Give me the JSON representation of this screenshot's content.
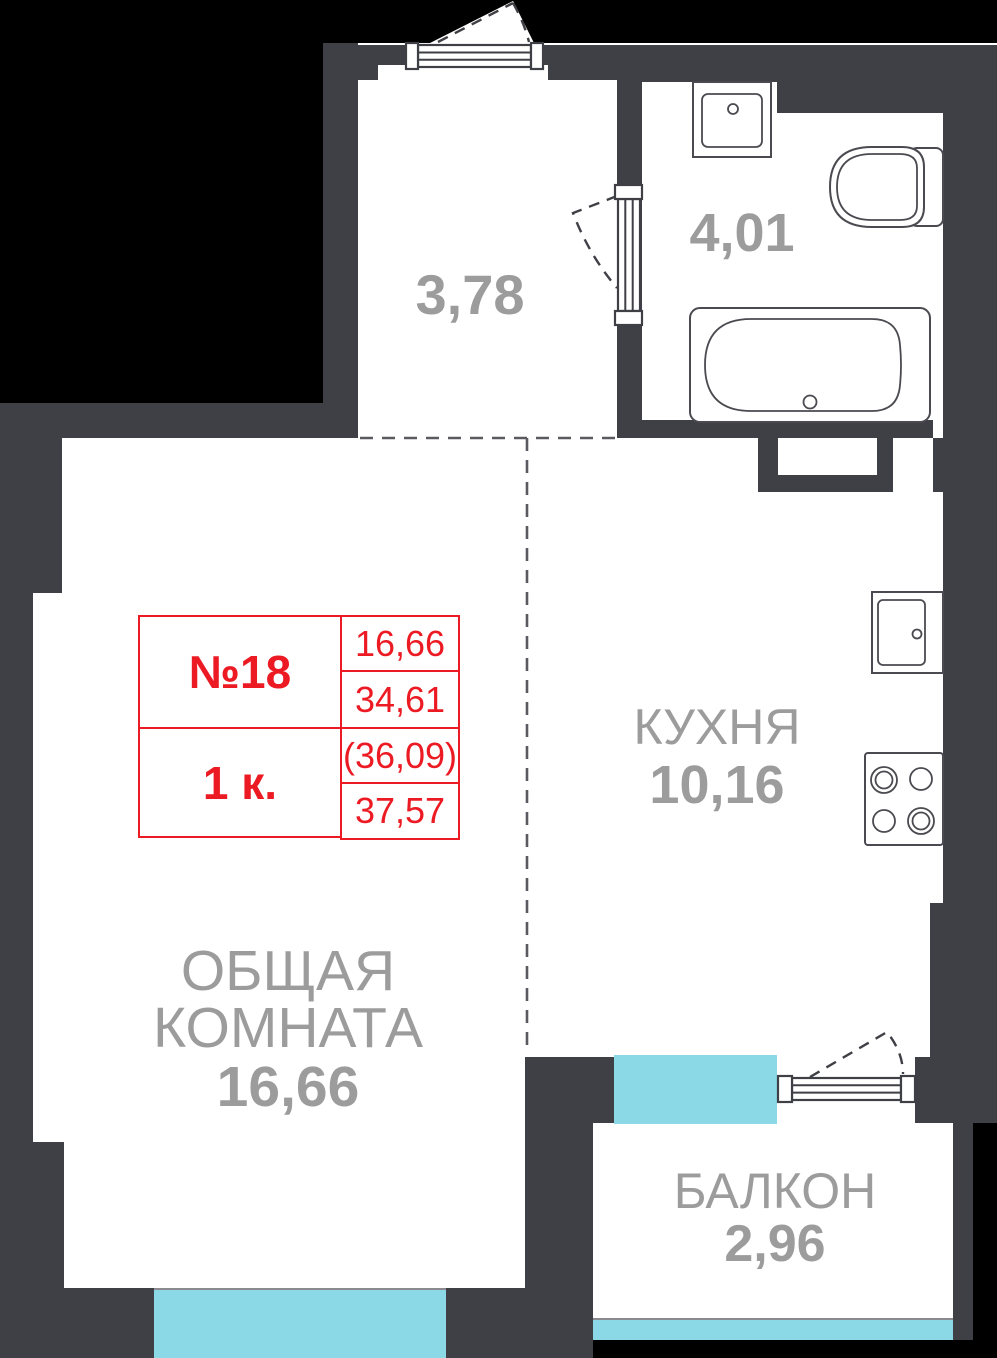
{
  "unit_card": {
    "unit_number": "№18",
    "room_count": "1 к.",
    "values": [
      "16,66",
      "34,61",
      "(36,09)",
      "37,57"
    ]
  },
  "rooms": {
    "hallway": {
      "area": "3,78"
    },
    "bathroom": {
      "area": "4,01"
    },
    "kitchen": {
      "name": "КУХНЯ",
      "area": "10,16"
    },
    "living": {
      "name_line1": "ОБЩАЯ",
      "name_line2": "КОМНАТА",
      "area": "16,66"
    },
    "balcony": {
      "name": "БАЛКОН",
      "area": "2,96"
    }
  },
  "fixtures": {
    "bathtub": "bathtub-icon",
    "toilet": "toilet-icon",
    "bathroom_sink": "sink-icon",
    "kitchen_sink": "kitchen-sink-icon",
    "stove": "stove-icon",
    "entrance_door": "door-swing-icon",
    "bathroom_door": "door-swing-icon",
    "balcony_door": "door-swing-icon"
  },
  "colors": {
    "wall": "#3F3F46",
    "exterior": "#000000",
    "window": "#8BD9E6",
    "accent_red": "#EC1B23",
    "label": "#9C9C9C",
    "fixture_outline": "#4A4A50",
    "dashed": "#5A5A61"
  }
}
